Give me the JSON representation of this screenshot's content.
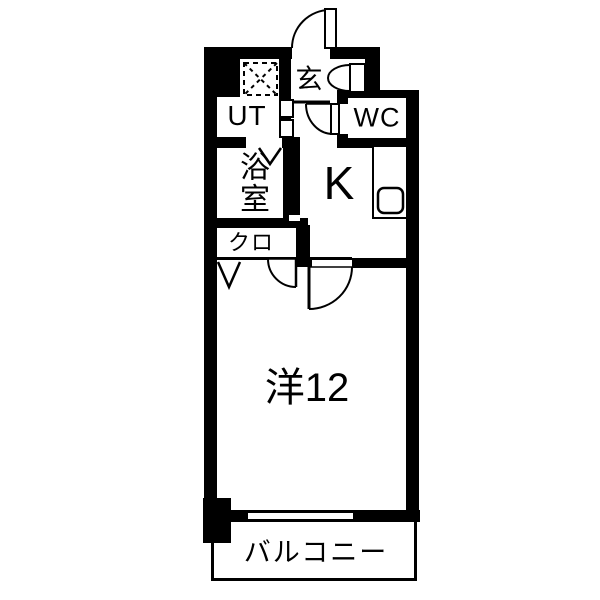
{
  "plan": {
    "kind": "japanese-apartment-floorplan",
    "layout_type": "1K",
    "rooms": {
      "genkan": {
        "label": "玄"
      },
      "utility": {
        "label": "UT"
      },
      "toilet": {
        "label": "WC"
      },
      "bathroom": {
        "label": "浴室"
      },
      "kitchen": {
        "label": "K"
      },
      "closet": {
        "label": "クロ"
      },
      "main_room": {
        "label": "洋12",
        "size_tatami": 12
      },
      "balcony": {
        "label": "バルコニー"
      }
    },
    "colors": {
      "wall": "#000000",
      "floor": "#ffffff"
    }
  }
}
